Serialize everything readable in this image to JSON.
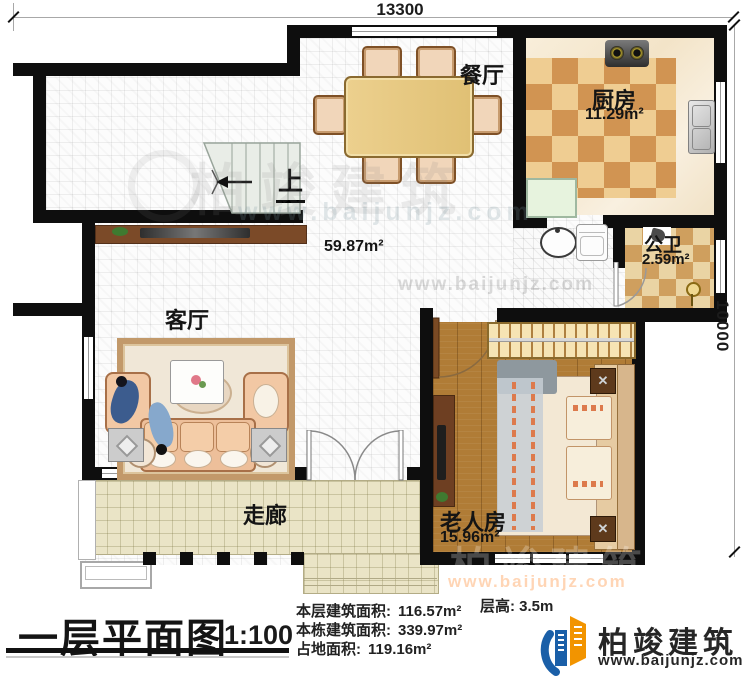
{
  "dimensions": {
    "width_mm": "13300",
    "height_mm": "10000"
  },
  "rooms": {
    "dining": {
      "name": "餐厅"
    },
    "kitchen": {
      "name": "厨房",
      "area": "11.29m²"
    },
    "bath": {
      "name": "公卫",
      "area": "2.59m²"
    },
    "living": {
      "name": "客厅"
    },
    "bedroom": {
      "name": "老人房",
      "area": "15.96m²"
    },
    "corridor": {
      "name": "走廊"
    },
    "hall": {
      "area": "59.87m²"
    },
    "stairs": {
      "up_label": "上"
    }
  },
  "title": {
    "text": "一层平面图",
    "scale": "1:100"
  },
  "stats": {
    "floor_height_label": "层高:",
    "floor_height_value": "3.5m",
    "rows": [
      {
        "label": "本层建筑面积:",
        "value": "116.57m²"
      },
      {
        "label": "本栋建筑面积:",
        "value": "339.97m²"
      },
      {
        "label": "占地面积:",
        "value": "119.16m²"
      }
    ]
  },
  "branding": {
    "name": "柏竣建筑",
    "website": "www.baijunjz.com"
  },
  "watermark": {
    "name": "柏竣建筑",
    "website": "www.baijunjz.com"
  },
  "colors": {
    "wall": "#0e0e0e",
    "brand_blue": "#1a5fa8",
    "brand_orange": "#f29400"
  }
}
